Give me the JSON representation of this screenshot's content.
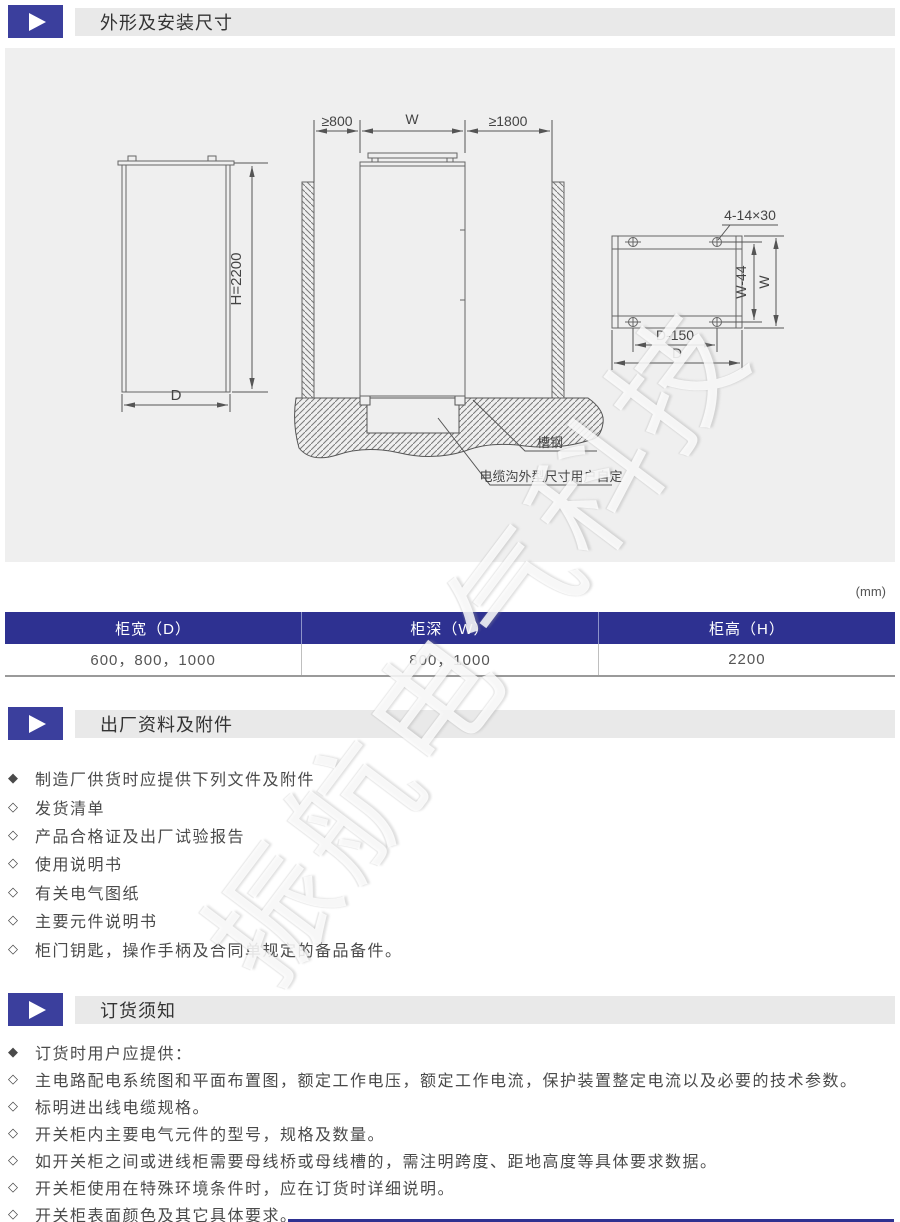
{
  "sections": {
    "dimensions": {
      "title": "外形及安装尺寸"
    },
    "factory": {
      "title": "出厂资料及附件"
    },
    "ordering": {
      "title": "订货须知"
    }
  },
  "diagram": {
    "front_view": {
      "height": "H=2200",
      "depth": "D"
    },
    "side_view": {
      "left_clearance": "≥800",
      "width": "W",
      "right_clearance": "≥1800",
      "channel_steel": "槽钢",
      "cable_trench_note": "电缆沟外型尺寸用户自定"
    },
    "plan_view": {
      "mounting_holes": "4-14×30",
      "inner_width": "W-44",
      "width": "W",
      "hole_spacing": "D-150",
      "depth": "D"
    }
  },
  "unit_note": "(mm)",
  "dimension_table": {
    "headers": [
      "柜宽（D）",
      "柜深（W）",
      "柜高（H）"
    ],
    "rows": [
      [
        "600，800，1000",
        "800，1000",
        "2200"
      ]
    ]
  },
  "factory_items": [
    {
      "bullet": "◆",
      "text": "制造厂供货时应提供下列文件及附件"
    },
    {
      "bullet": "◇",
      "text": "发货清单"
    },
    {
      "bullet": "◇",
      "text": "产品合格证及出厂试验报告"
    },
    {
      "bullet": "◇",
      "text": "使用说明书"
    },
    {
      "bullet": "◇",
      "text": "有关电气图纸"
    },
    {
      "bullet": "◇",
      "text": "主要元件说明书"
    },
    {
      "bullet": "◇",
      "text": "柜门钥匙，操作手柄及合同单规定的备品备件。"
    }
  ],
  "ordering_items": [
    {
      "bullet": "◆",
      "text": "订货时用户应提供："
    },
    {
      "bullet": "◇",
      "text": "主电路配电系统图和平面布置图，额定工作电压，额定工作电流，保护装置整定电流以及必要的技术参数。"
    },
    {
      "bullet": "◇",
      "text": "标明进出线电缆规格。"
    },
    {
      "bullet": "◇",
      "text": "开关柜内主要电气元件的型号，规格及数量。"
    },
    {
      "bullet": "◇",
      "text": "如开关柜之间或进线柜需要母线桥或母线槽的，需注明跨度、距地高度等具体要求数据。"
    },
    {
      "bullet": "◇",
      "text": "开关柜使用在特殊环境条件时，应在订货时详细说明。"
    },
    {
      "bullet": "◇",
      "text": "开关柜表面颜色及其它具体要求。"
    }
  ],
  "watermark": "振航电气科技",
  "colors": {
    "accent": "#2e3191",
    "icon_blue": "#3b3f9d",
    "bar_gray": "#e9e9e9",
    "panel_gray": "#efefef"
  }
}
